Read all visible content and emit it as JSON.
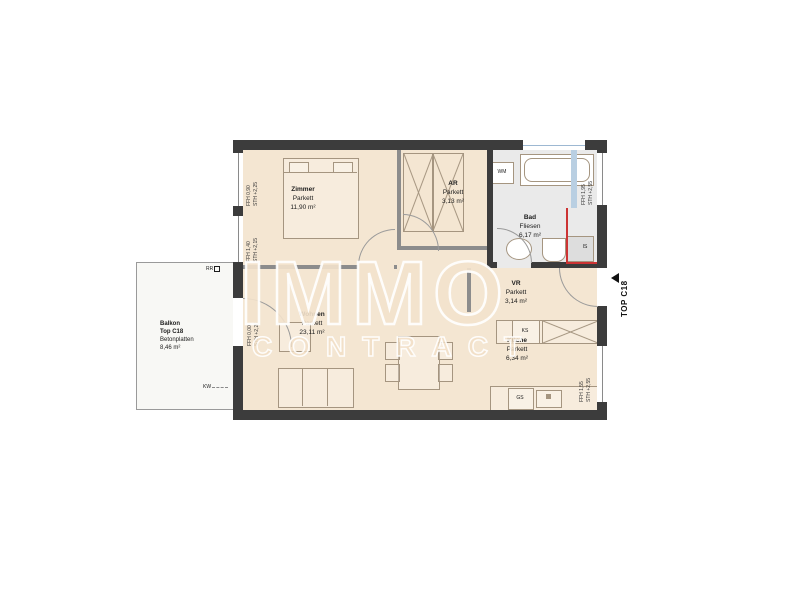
{
  "watermark": {
    "line1": "IMMO",
    "line2": "CONTRACT"
  },
  "unit_marker": {
    "label": "TOP C18"
  },
  "rooms": {
    "zimmer": {
      "name": "Zimmer",
      "floor": "Parkett",
      "area": "11,90 m²"
    },
    "ar": {
      "name": "AR",
      "floor": "Parkett",
      "area": "3,13 m²"
    },
    "bad": {
      "name": "Bad",
      "floor": "Fliesen",
      "area": "6,17 m²"
    },
    "vr": {
      "name": "VR",
      "floor": "Parkett",
      "area": "3,14 m²"
    },
    "wohnen": {
      "name": "Wohnen",
      "floor": "Parkett",
      "area": "23,11 m²"
    },
    "kueche": {
      "name": "Küche",
      "floor": "Parkett",
      "area": "6,34 m²"
    },
    "balkon": {
      "name": "Balkon",
      "unit": "Top C18",
      "floor": "Betonplatten",
      "area": "8,46 m²"
    }
  },
  "appliances": {
    "wm": "WM",
    "ks": "KS",
    "gs": "GS",
    "is": "IS"
  },
  "window_annotations": {
    "left_top": "FFH 0,90\nSTH +2,25",
    "left_mid": "FFH 1,40\nSTH +2,15",
    "balcony_door": "FFH 0,00\nSTH +2,26",
    "right_top": "FFH 1,95\nSTH +2,55",
    "right_bottom": "FFH 1,55\nSTH +2,55"
  },
  "misc": {
    "rr": "RR",
    "kw": "KW"
  },
  "colors": {
    "wall": "#3c3c3c",
    "partition": "#8c8c8c",
    "floor": "#f4e6d2",
    "bad_floor": "#eaeaea",
    "accent_red": "#cc3333",
    "accent_blue": "#b9cfe2",
    "watermark": "#f1dec5"
  }
}
